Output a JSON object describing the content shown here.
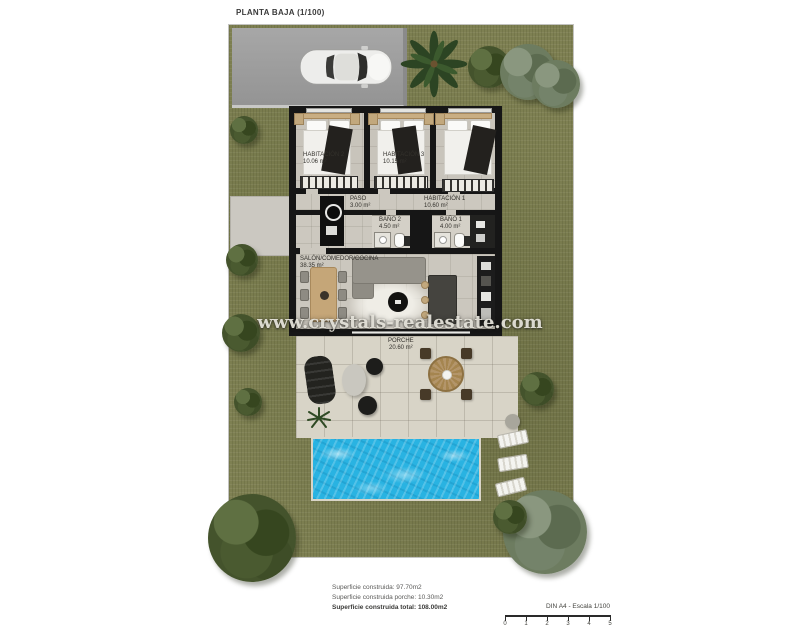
{
  "title": "PLANTA BAJA (1/100)",
  "watermark": "www.crystals-realestate.com",
  "rooms": {
    "habitacion2": {
      "name": "HABITACIÓN 2",
      "area": "10.06 m²"
    },
    "habitacion3": {
      "name": "HABITACIÓN 3",
      "area": "10.15 m²"
    },
    "habitacion1": {
      "name": "HABITACIÓN 1",
      "area": "10.60 m²"
    },
    "paso": {
      "name": "PASO",
      "area": "3.00 m²"
    },
    "bano2": {
      "name": "BAÑO 2",
      "area": "4.50 m²"
    },
    "bano1": {
      "name": "BAÑO 1",
      "area": "4.00 m²"
    },
    "salon": {
      "name": "SALÓN/COMEDOR/COCINA",
      "area": "38.35 m²"
    },
    "porche": {
      "name": "PORCHE",
      "area": "20.60 m²"
    }
  },
  "summary": {
    "built": "Superficie construida: 97.70m2",
    "porch": "Superficie construida porche: 10.30m2",
    "total": "Superficie construida total: 108.00m2"
  },
  "scalebar": {
    "label": "DIN A4 - Escala 1/100",
    "ticks": [
      "0",
      "1",
      "2",
      "3",
      "4",
      "5"
    ]
  },
  "colors": {
    "grass": "#7e8052",
    "driveway": "#9d9d9d",
    "wall": "#161616",
    "interior_floor": "#c8c4bb",
    "terrace": "#d8d4c7",
    "pool_water": "#29b3e2",
    "wood": "#c5a678"
  }
}
